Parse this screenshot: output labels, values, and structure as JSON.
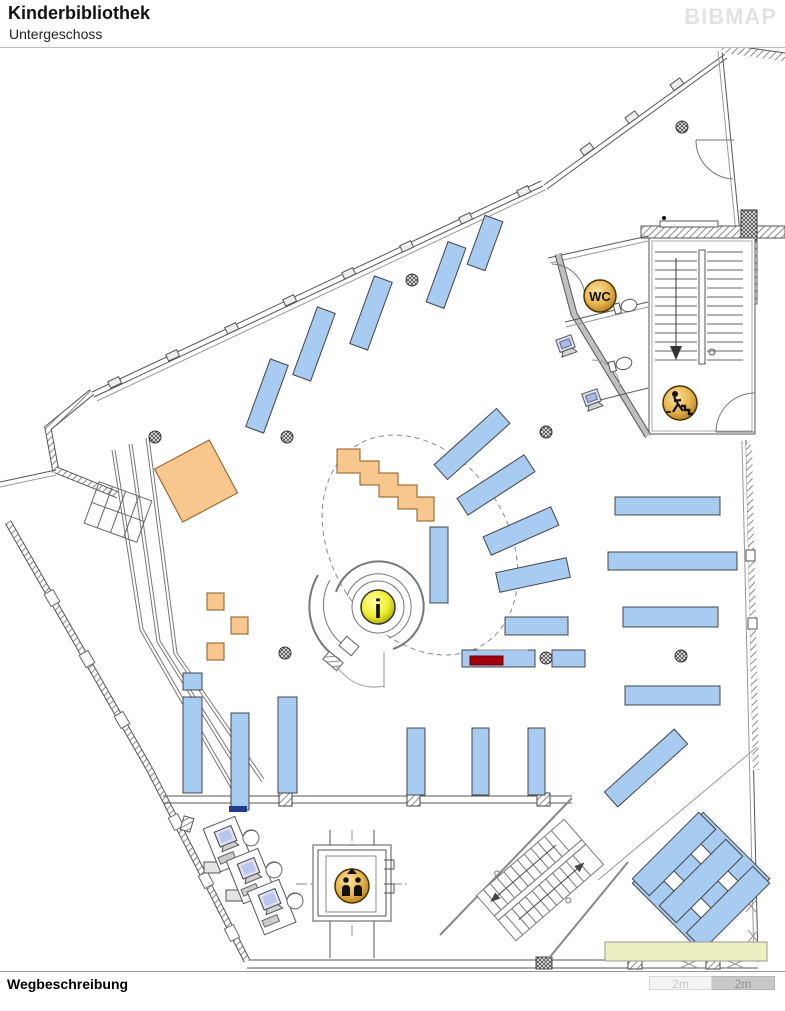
{
  "header": {
    "title": "Kinderbibliothek",
    "subtitle": "Untergeschoss",
    "logo": "BIBMAP"
  },
  "map": {
    "name": "Grundriss Kinderbibliothek Untergeschoss",
    "icons": {
      "wc_label": "WC",
      "info_label": "i",
      "stairs_icon": "person-descending-stairs",
      "elevator_icon": "two-persons-elevator"
    },
    "colors": {
      "shelf_blue": "#a8cbf2",
      "furniture_orange": "#f8c78e",
      "highlight_red": "#a00010",
      "bench_yellow": "#eeefc0",
      "icon_gold": "#e2ae48",
      "icon_yellow": "#efef30",
      "wall_gray": "#555555"
    }
  },
  "footer": {
    "waydescription_label": "Wegbeschreibung",
    "scale_segments": [
      "2m",
      "2m"
    ]
  }
}
